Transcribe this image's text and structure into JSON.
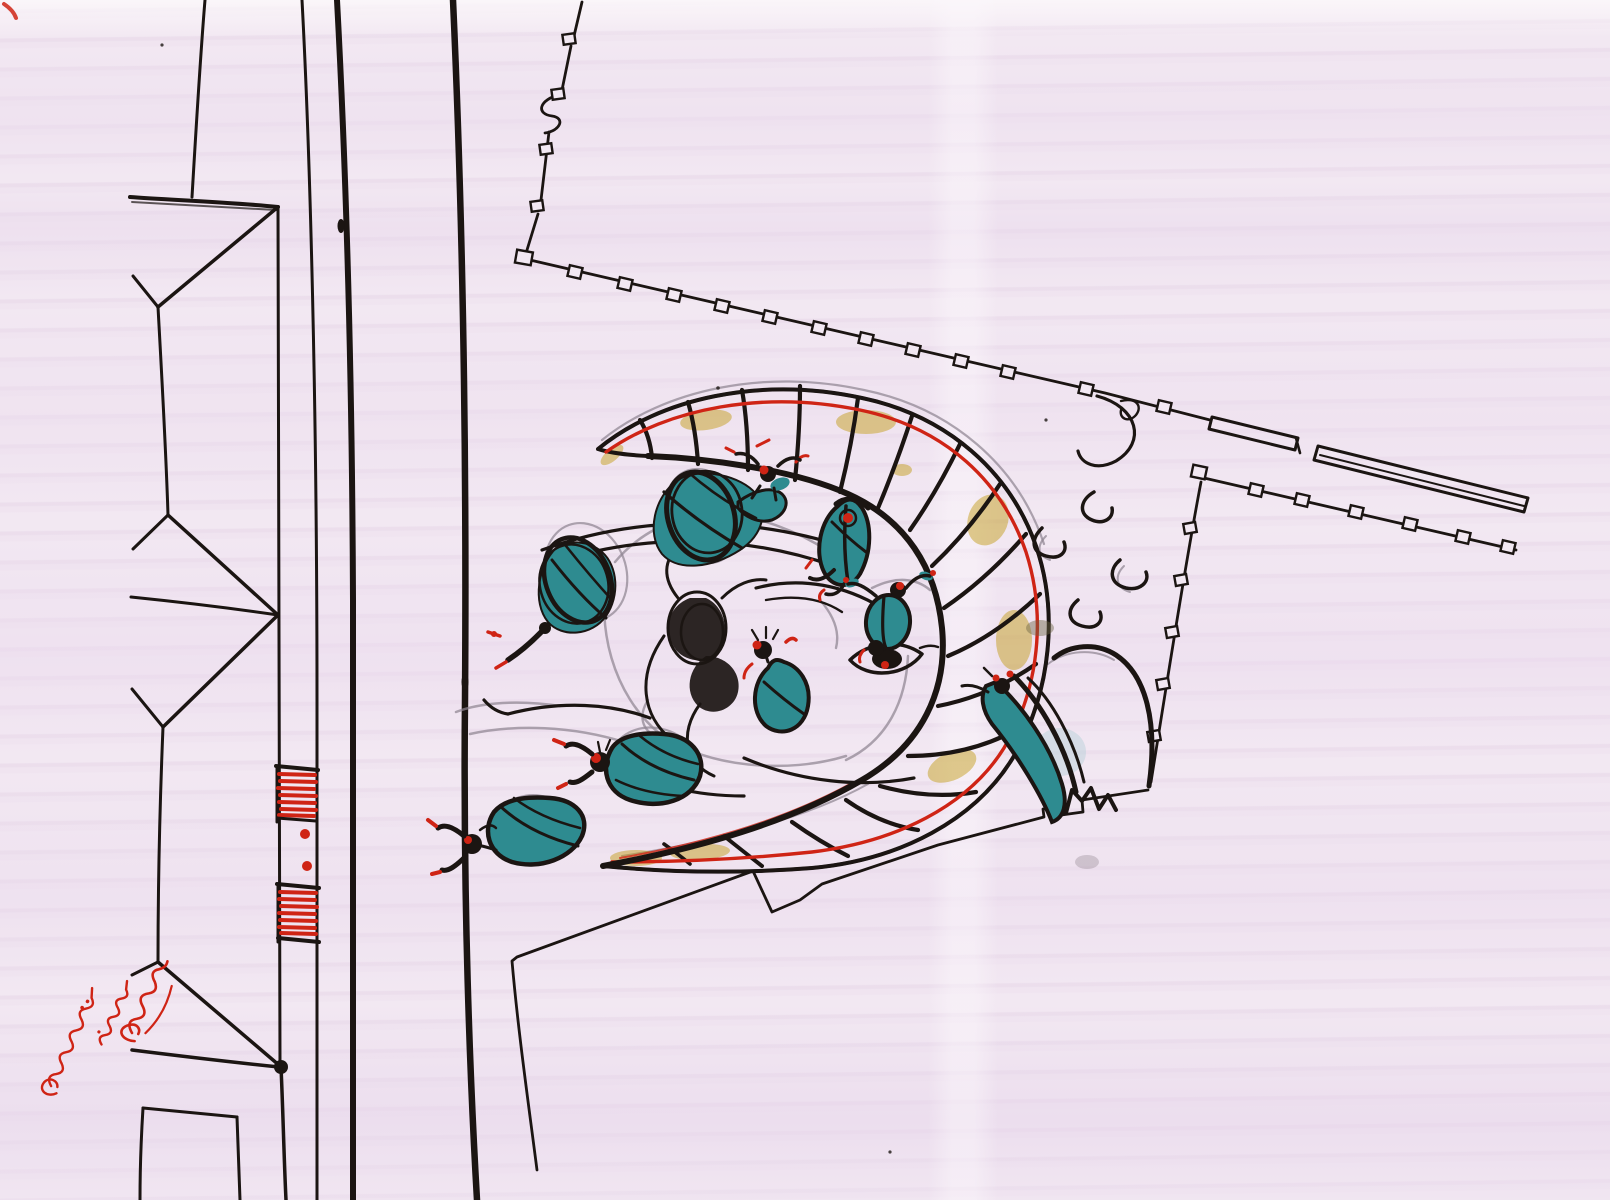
{
  "artwork": {
    "kind": "hand-drawn concept sketch",
    "media": "black ink, graphite pencil, yellow and teal watercolor, red ink on mauve-washed paper",
    "scene": "plan-view street grid with pedestrian crossing at left, survey boundary lines with small square markers, a large ribbed yellow crescent canopy sheltering a sketched horse head, teal tadpole-like figures scattered around, red handwritten signature at lower left"
  },
  "palette": {
    "paper": "#f2e8f2",
    "paper_streak": "#e3d2e5",
    "ink": "#1b1512",
    "pencil": "#8f8591",
    "yellow": "#e4bb16",
    "yellow_shade": "#bf9708",
    "teal": "#2e8b90",
    "teal_deep": "#1f666e",
    "red": "#cf2415",
    "red_deep": "#a11212",
    "pale_blue": "#b9d2da"
  },
  "signature": {
    "color": "#cf2415",
    "position": "bottom-left, rotated steeply",
    "legible": false,
    "rows": 3
  },
  "inventory": {
    "street_lines": 4,
    "building_gables": 3,
    "crosswalk_stripe_groups": 2,
    "crosswalk_red_bars_per_group": 7,
    "survey_marker_squares": 29,
    "teal_figures": 8,
    "crescent_ribs": 17,
    "smoke_curls": 4
  }
}
